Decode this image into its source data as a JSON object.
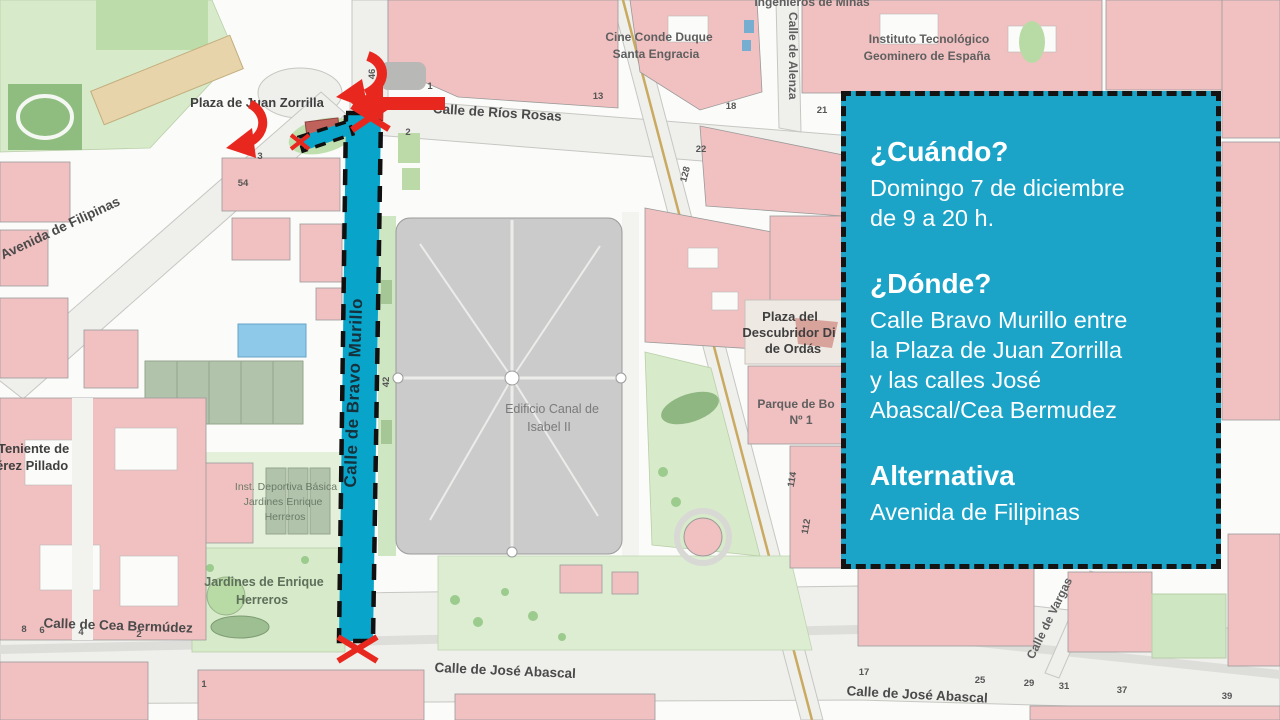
{
  "infobox": {
    "when_title": "¿Cuándo?",
    "when_line1": "Domingo 7 de diciembre",
    "when_line2": "de 9 a 20 h.",
    "where_title": "¿Dónde?",
    "where_line1": "Calle Bravo Murillo entre",
    "where_line2": "la Plaza de Juan Zorrilla",
    "where_line3": "y las calles José",
    "where_line4": "Abascal/Cea Bermudez",
    "alt_title": "Alternativa",
    "alt_line1": "Avenida de Filipinas"
  },
  "colors": {
    "infobox_bg": "#1ba3c8",
    "closed_street_highlight": "#09a4ca",
    "closure_red": "#e8281e",
    "building_pink": "#f1c0c1",
    "park_green": "#d7eaca",
    "canal_gray": "#cbcbcb"
  },
  "map": {
    "street_labels": {
      "rios_rosas": "Calle de Ríos Rosas",
      "filipinas": "Avenida de Filipinas",
      "bravo_murillo": "Calle de Bravo Murillo",
      "cea_bermudez": "Calle de Cea Bermúdez",
      "jose_abascal": "Calle de José Abascal",
      "jose_abascal_2": "Calle de José Abascal",
      "alenza": "Calle de Alenza",
      "vargas": "Calle de Vargas"
    },
    "place_labels": {
      "plaza_juan_zorrilla": "Plaza de Juan Zorrilla",
      "cine_l1": "Cine  Conde Duque",
      "cine_l2": "Santa Engracia",
      "instituto_l1": "Instituto  Tecnológico",
      "instituto_l2": "Geominero de España",
      "ingenieros": "Ingenieros de Minas",
      "canal_l1": "Edificio  Canal de",
      "canal_l2": "Isabel II",
      "descubridor_l1": "Plaza del",
      "descubridor_l2": "Descubridor Di",
      "descubridor_l3": "de Ordás",
      "bomberos_l1": "Parque de Bo",
      "bomberos_l2": "Nº 1",
      "jardines_l1": "Jardines de Enrique",
      "jardines_l2": "Herreros",
      "deportiva_l1": "Inst. Deportiva Básica",
      "deportiva_l2": "Jardines Enrique",
      "deportiva_l3": "Herreros",
      "teniente_l1": "Teniente de",
      "teniente_l2": "érez Pillado"
    },
    "numbers": [
      "46",
      "42",
      "54",
      "3",
      "2",
      "1",
      "13",
      "18",
      "21",
      "22",
      "128",
      "114",
      "112",
      "8",
      "6",
      "4",
      "2",
      "17",
      "25",
      "29",
      "31",
      "37",
      "39",
      "1"
    ]
  }
}
